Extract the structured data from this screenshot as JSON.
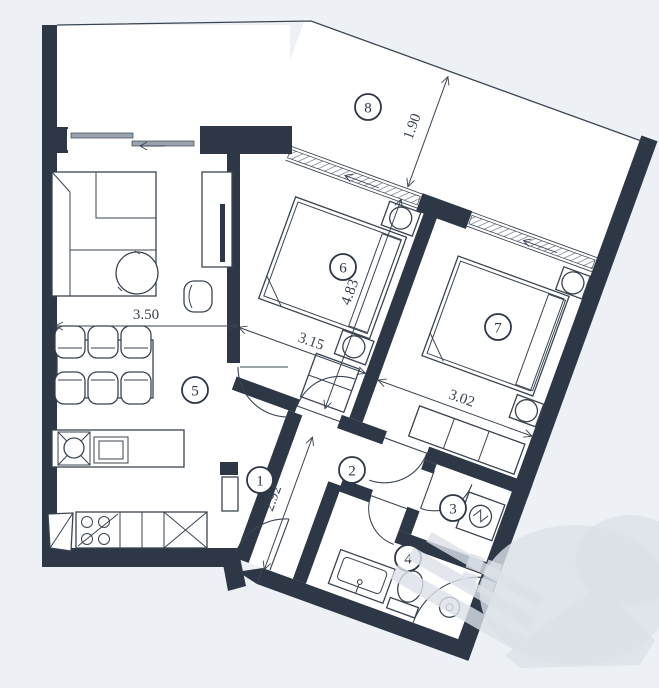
{
  "colors": {
    "background": "#edf1f6",
    "wall": "#2d3745",
    "line": "#3a4450",
    "sill": "#9aa3ae",
    "paper": "#ffffff",
    "watermark": "#dce1e8"
  },
  "rooms": {
    "r1": "1",
    "r2": "2",
    "r3": "3",
    "r4": "4",
    "r5": "5",
    "r6": "6",
    "r7": "7",
    "r8": "8"
  },
  "dimensions": {
    "d350": "3.50",
    "d315": "3.15",
    "d483": "4.83",
    "d302": "3.02",
    "d292": "2.92",
    "d190": "1.90"
  }
}
